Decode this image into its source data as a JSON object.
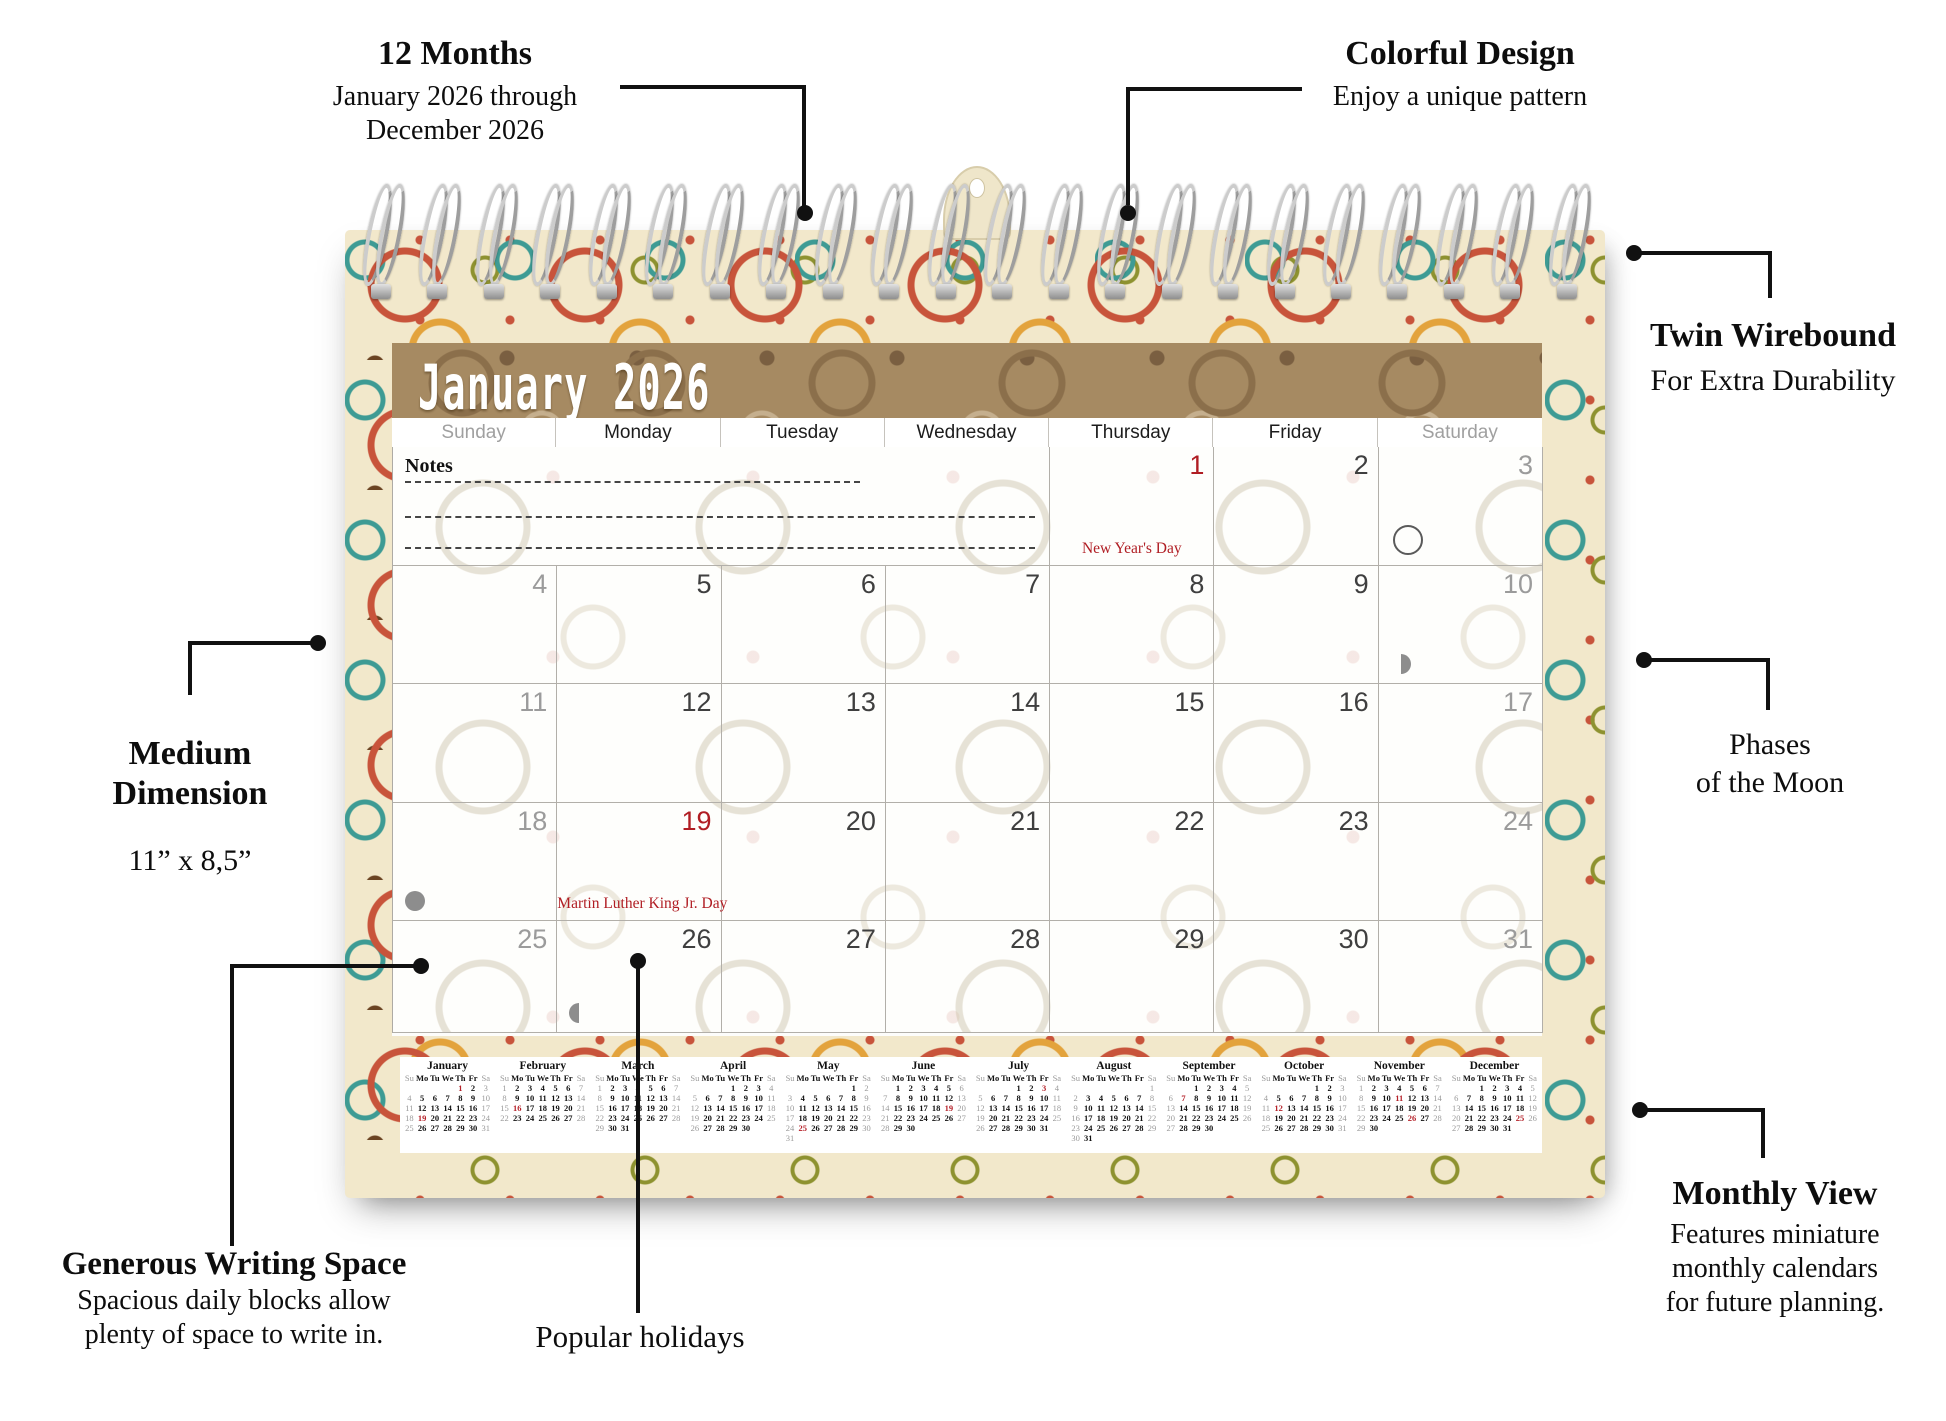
{
  "colors": {
    "holiday_red": "#b01d23",
    "mini_red": "#b5222a",
    "title_bar_brown": "#a68a62",
    "board_cream": "#f2e8cb",
    "muted_gray": "#9b9b9b"
  },
  "callouts": {
    "months": {
      "title": "12 Months",
      "line1": "January 2026 through",
      "line2": "December 2026"
    },
    "design": {
      "title": "Colorful Design",
      "body": "Enjoy a unique pattern"
    },
    "wirebound": {
      "title": "Twin Wirebound",
      "body": "For Extra Durability"
    },
    "moon": {
      "line1": "Phases",
      "line2": "of the Moon"
    },
    "dimension": {
      "title1": "Medium",
      "title2": "Dimension",
      "body": "11” x 8,5”"
    },
    "writing": {
      "title": "Generous Writing Space",
      "line1": "Spacious daily blocks allow",
      "line2": "plenty of space to write in."
    },
    "popular": {
      "title": "Popular holidays"
    },
    "monthly": {
      "title": "Monthly View",
      "line1": "Features miniature",
      "line2": "monthly calendars",
      "line3": "for future planning."
    }
  },
  "calendar": {
    "title": "January 2026",
    "notes_label": "Notes",
    "day_headers": [
      {
        "label": "Sunday",
        "muted": true
      },
      {
        "label": "Monday",
        "muted": false
      },
      {
        "label": "Tuesday",
        "muted": false
      },
      {
        "label": "Wednesday",
        "muted": false
      },
      {
        "label": "Thursday",
        "muted": false
      },
      {
        "label": "Friday",
        "muted": false
      },
      {
        "label": "Saturday",
        "muted": true
      }
    ],
    "cells": [
      {
        "day": 1,
        "red": true,
        "holiday": "New Year's Day"
      },
      {
        "day": 2
      },
      {
        "day": 3,
        "muted": true,
        "moon": "full"
      },
      {
        "day": 4,
        "muted": true
      },
      {
        "day": 5
      },
      {
        "day": 6
      },
      {
        "day": 7
      },
      {
        "day": 8
      },
      {
        "day": 9
      },
      {
        "day": 10,
        "muted": true,
        "moon": "last"
      },
      {
        "day": 11,
        "muted": true
      },
      {
        "day": 12
      },
      {
        "day": 13
      },
      {
        "day": 14
      },
      {
        "day": 15
      },
      {
        "day": 16
      },
      {
        "day": 17,
        "muted": true
      },
      {
        "day": 18,
        "muted": true,
        "moon": "new"
      },
      {
        "day": 19,
        "red": true,
        "holiday": "Martin Luther King Jr. Day"
      },
      {
        "day": 20
      },
      {
        "day": 21
      },
      {
        "day": 22
      },
      {
        "day": 23
      },
      {
        "day": 24,
        "muted": true
      },
      {
        "day": 25,
        "muted": true
      },
      {
        "day": 26,
        "moon": "first"
      },
      {
        "day": 27
      },
      {
        "day": 28
      },
      {
        "day": 29
      },
      {
        "day": 30
      },
      {
        "day": 31,
        "muted": true
      }
    ]
  },
  "mini_day_headers": [
    "Su",
    "Mo",
    "Tu",
    "We",
    "Th",
    "Fr",
    "Sa"
  ],
  "mini_months": [
    {
      "name": "January",
      "red": [
        1,
        19
      ],
      "weeks": [
        [
          "",
          "",
          "",
          "",
          1,
          2,
          3
        ],
        [
          4,
          5,
          6,
          7,
          8,
          9,
          10
        ],
        [
          11,
          12,
          13,
          14,
          15,
          16,
          17
        ],
        [
          18,
          19,
          20,
          21,
          22,
          23,
          24
        ],
        [
          25,
          26,
          27,
          28,
          29,
          30,
          31
        ]
      ]
    },
    {
      "name": "February",
      "red": [
        16
      ],
      "weeks": [
        [
          1,
          2,
          3,
          4,
          5,
          6,
          7
        ],
        [
          8,
          9,
          10,
          11,
          12,
          13,
          14
        ],
        [
          15,
          16,
          17,
          18,
          19,
          20,
          21
        ],
        [
          22,
          23,
          24,
          25,
          26,
          27,
          28
        ]
      ]
    },
    {
      "name": "March",
      "red": [],
      "weeks": [
        [
          1,
          2,
          3,
          4,
          5,
          6,
          7
        ],
        [
          8,
          9,
          10,
          11,
          12,
          13,
          14
        ],
        [
          15,
          16,
          17,
          18,
          19,
          20,
          21
        ],
        [
          22,
          23,
          24,
          25,
          26,
          27,
          28
        ],
        [
          29,
          30,
          31,
          "",
          "",
          "",
          ""
        ]
      ]
    },
    {
      "name": "April",
      "red": [],
      "weeks": [
        [
          "",
          "",
          "",
          1,
          2,
          3,
          4
        ],
        [
          5,
          6,
          7,
          8,
          9,
          10,
          11
        ],
        [
          12,
          13,
          14,
          15,
          16,
          17,
          18
        ],
        [
          19,
          20,
          21,
          22,
          23,
          24,
          25
        ],
        [
          26,
          27,
          28,
          29,
          30,
          "",
          ""
        ]
      ]
    },
    {
      "name": "May",
      "red": [
        25
      ],
      "weeks": [
        [
          "",
          "",
          "",
          "",
          "",
          1,
          2
        ],
        [
          3,
          4,
          5,
          6,
          7,
          8,
          9
        ],
        [
          10,
          11,
          12,
          13,
          14,
          15,
          16
        ],
        [
          17,
          18,
          19,
          20,
          21,
          22,
          23
        ],
        [
          24,
          25,
          26,
          27,
          28,
          29,
          30
        ],
        [
          31,
          "",
          "",
          "",
          "",
          "",
          ""
        ]
      ]
    },
    {
      "name": "June",
      "red": [
        19
      ],
      "weeks": [
        [
          "",
          1,
          2,
          3,
          4,
          5,
          6
        ],
        [
          7,
          8,
          9,
          10,
          11,
          12,
          13
        ],
        [
          14,
          15,
          16,
          17,
          18,
          19,
          20
        ],
        [
          21,
          22,
          23,
          24,
          25,
          26,
          27
        ],
        [
          28,
          29,
          30,
          "",
          "",
          "",
          ""
        ]
      ]
    },
    {
      "name": "July",
      "red": [
        3
      ],
      "weeks": [
        [
          "",
          "",
          "",
          1,
          2,
          3,
          4
        ],
        [
          5,
          6,
          7,
          8,
          9,
          10,
          11
        ],
        [
          12,
          13,
          14,
          15,
          16,
          17,
          18
        ],
        [
          19,
          20,
          21,
          22,
          23,
          24,
          25
        ],
        [
          26,
          27,
          28,
          29,
          30,
          31,
          ""
        ]
      ]
    },
    {
      "name": "August",
      "red": [],
      "weeks": [
        [
          "",
          "",
          "",
          "",
          "",
          "",
          1
        ],
        [
          2,
          3,
          4,
          5,
          6,
          7,
          8
        ],
        [
          9,
          10,
          11,
          12,
          13,
          14,
          15
        ],
        [
          16,
          17,
          18,
          19,
          20,
          21,
          22
        ],
        [
          23,
          24,
          25,
          26,
          27,
          28,
          29
        ],
        [
          30,
          31,
          "",
          "",
          "",
          "",
          ""
        ]
      ]
    },
    {
      "name": "September",
      "red": [
        7
      ],
      "weeks": [
        [
          "",
          "",
          1,
          2,
          3,
          4,
          5
        ],
        [
          6,
          7,
          8,
          9,
          10,
          11,
          12
        ],
        [
          13,
          14,
          15,
          16,
          17,
          18,
          19
        ],
        [
          20,
          21,
          22,
          23,
          24,
          25,
          26
        ],
        [
          27,
          28,
          29,
          30,
          "",
          "",
          ""
        ]
      ]
    },
    {
      "name": "October",
      "red": [
        12
      ],
      "weeks": [
        [
          "",
          "",
          "",
          "",
          1,
          2,
          3
        ],
        [
          4,
          5,
          6,
          7,
          8,
          9,
          10
        ],
        [
          11,
          12,
          13,
          14,
          15,
          16,
          17
        ],
        [
          18,
          19,
          20,
          21,
          22,
          23,
          24
        ],
        [
          25,
          26,
          27,
          28,
          29,
          30,
          31
        ]
      ]
    },
    {
      "name": "November",
      "red": [
        11,
        26
      ],
      "weeks": [
        [
          1,
          2,
          3,
          4,
          5,
          6,
          7
        ],
        [
          8,
          9,
          10,
          11,
          12,
          13,
          14
        ],
        [
          15,
          16,
          17,
          18,
          19,
          20,
          21
        ],
        [
          22,
          23,
          24,
          25,
          26,
          27,
          28
        ],
        [
          29,
          30,
          "",
          "",
          "",
          "",
          ""
        ]
      ]
    },
    {
      "name": "December",
      "red": [
        25
      ],
      "weeks": [
        [
          "",
          "",
          1,
          2,
          3,
          4,
          5
        ],
        [
          6,
          7,
          8,
          9,
          10,
          11,
          12
        ],
        [
          13,
          14,
          15,
          16,
          17,
          18,
          19
        ],
        [
          20,
          21,
          22,
          23,
          24,
          25,
          26
        ],
        [
          27,
          28,
          29,
          30,
          31,
          "",
          ""
        ]
      ]
    }
  ]
}
